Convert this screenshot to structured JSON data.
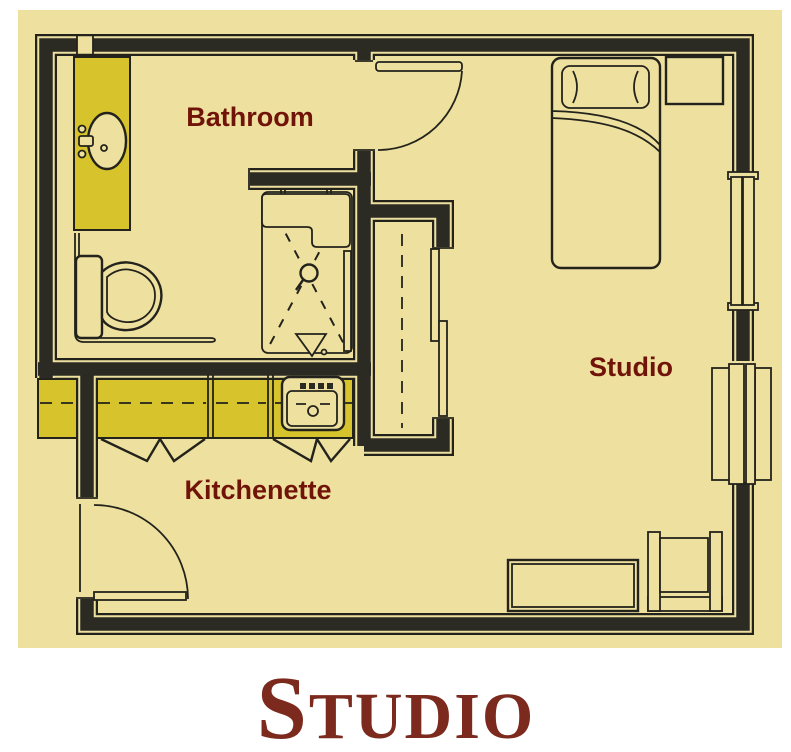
{
  "page": {
    "background": "#ffffff"
  },
  "plan": {
    "background": "#eee1a0",
    "wall_color": "#2b2b24",
    "line_color": "#23231c",
    "counter_color": "#d7c32b",
    "label_color": "#701409",
    "rooms": {
      "bathroom": {
        "label": "Bathroom"
      },
      "studio": {
        "label": "Studio"
      },
      "kitchenette": {
        "label": "Kitchenette"
      }
    }
  },
  "caption": {
    "initial": "S",
    "rest": "TUDIO",
    "color": "#7c2a1d"
  }
}
